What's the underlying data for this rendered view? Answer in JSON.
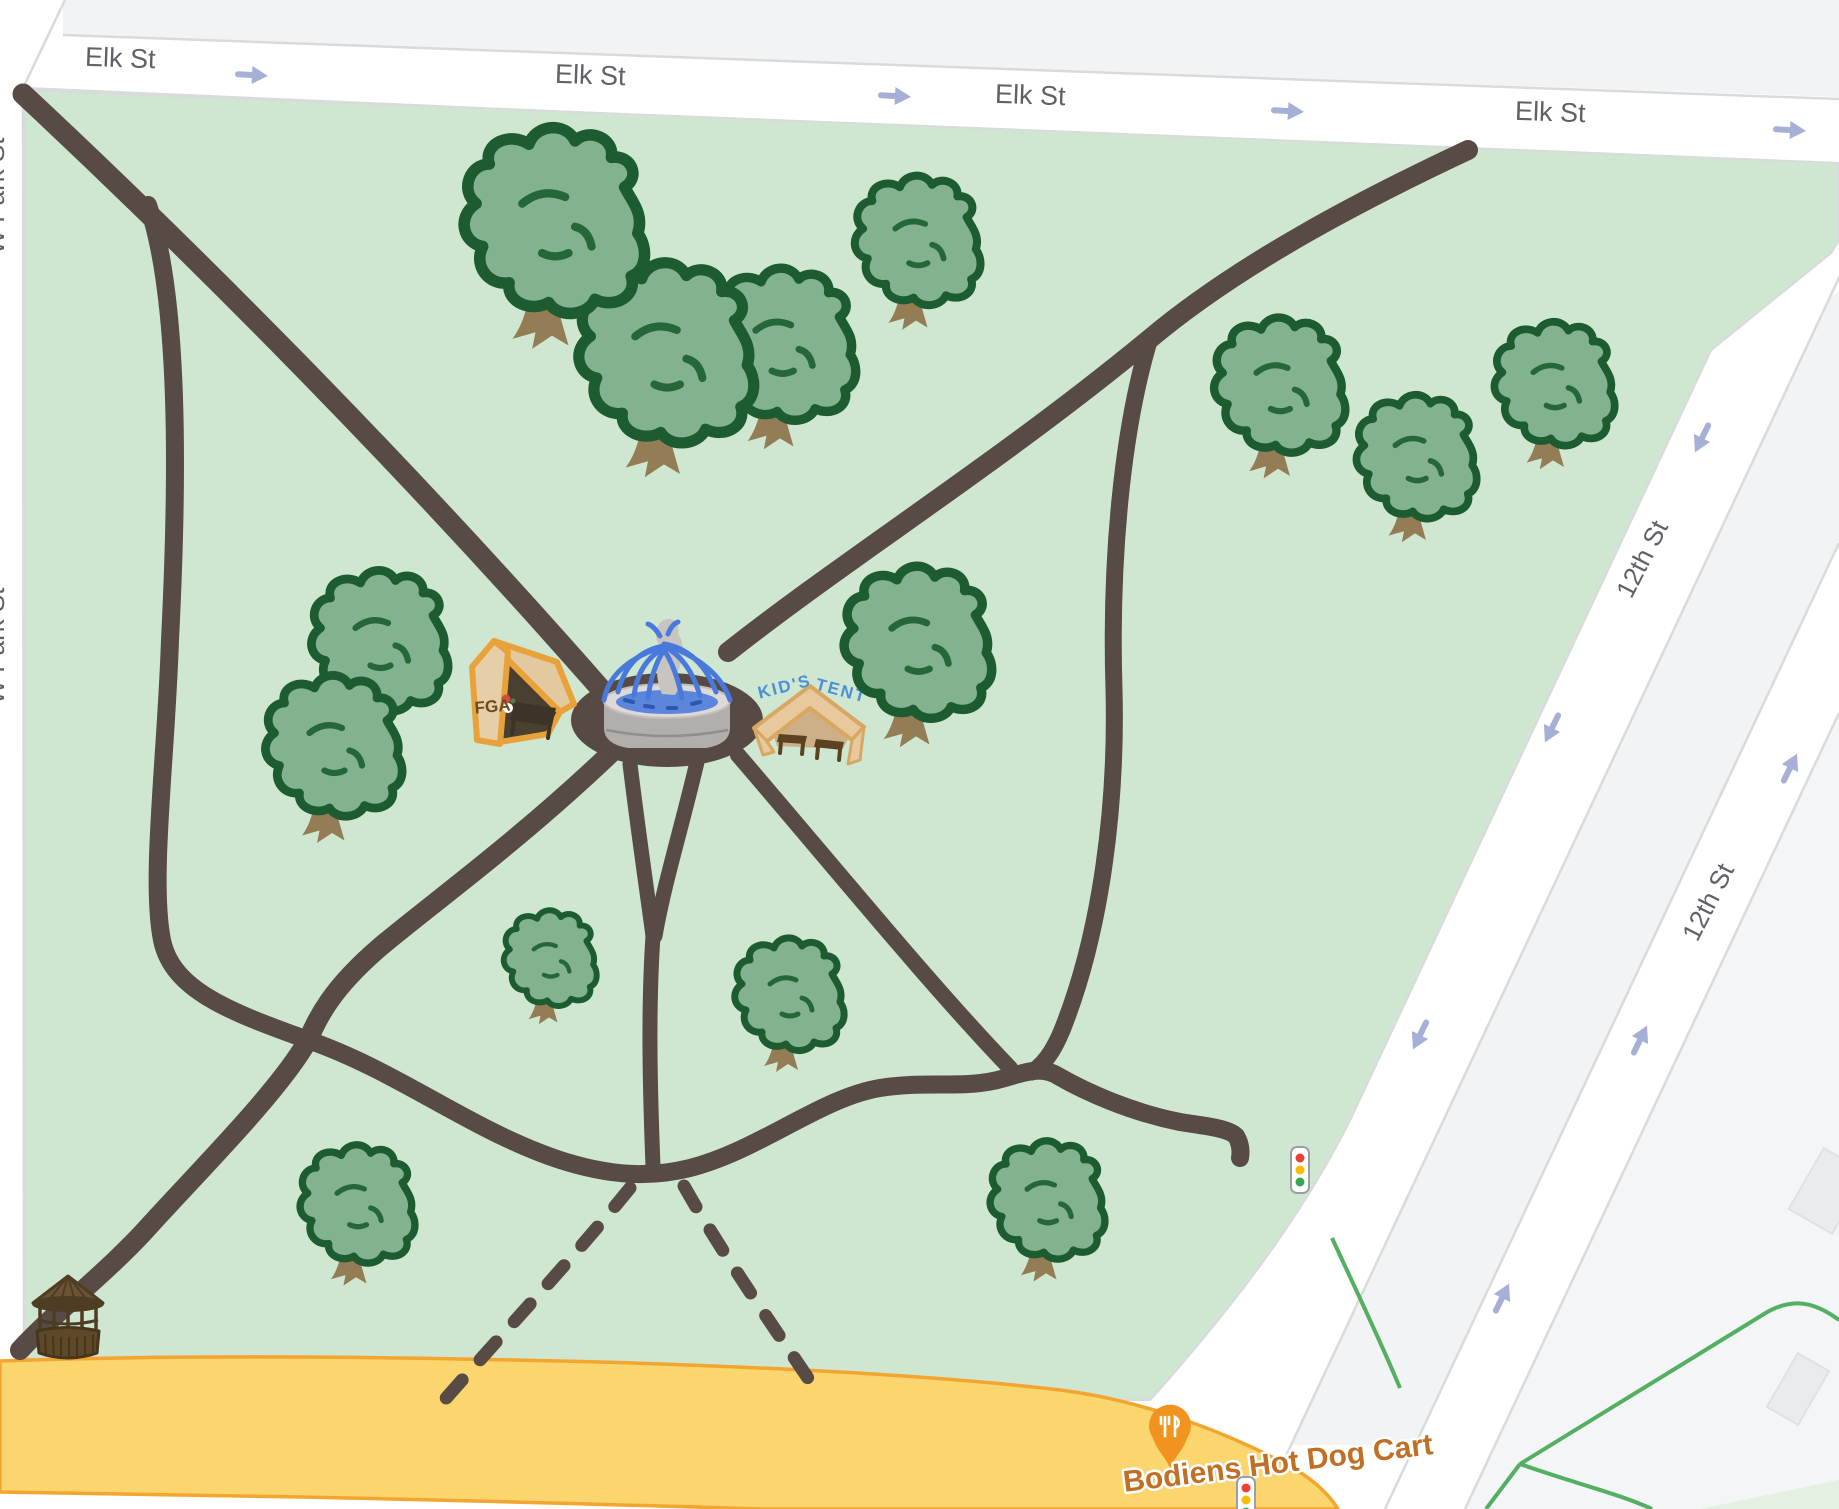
{
  "app": {
    "type": "map-view",
    "description": "park map with hand-drawn event overlay"
  },
  "streets": {
    "elk": {
      "name": "Elk St",
      "labels": [
        {
          "x": 120,
          "y": 67,
          "r": 2
        },
        {
          "x": 590,
          "y": 84,
          "r": 2
        },
        {
          "x": 1030,
          "y": 104,
          "r": 2
        },
        {
          "x": 1550,
          "y": 121,
          "r": 2
        }
      ],
      "arrows": [
        {
          "x": 252,
          "y": 75,
          "r": 3
        },
        {
          "x": 895,
          "y": 96,
          "r": 3
        },
        {
          "x": 1288,
          "y": 111,
          "r": 3
        },
        {
          "x": 1790,
          "y": 130,
          "r": 3
        }
      ]
    },
    "twelfth": {
      "name": "12th St",
      "labels": [
        {
          "x": 1650,
          "y": 563,
          "r": -63
        },
        {
          "x": 1716,
          "y": 906,
          "r": -63
        }
      ],
      "arrows_southbound": [
        {
          "x": 1702,
          "y": 438,
          "r": 116
        },
        {
          "x": 1552,
          "y": 728,
          "r": 116
        },
        {
          "x": 1420,
          "y": 1035,
          "r": 116
        }
      ],
      "arrows_northbound": [
        {
          "x": 1790,
          "y": 768,
          "r": -64
        },
        {
          "x": 1640,
          "y": 1040,
          "r": -64
        },
        {
          "x": 1502,
          "y": 1298,
          "r": -64
        }
      ]
    },
    "wpark": {
      "name": "W Park St",
      "labels": [
        {
          "x": 4,
          "y": 196,
          "r": -90
        },
        {
          "x": 4,
          "y": 646,
          "r": -90
        }
      ]
    }
  },
  "poi": {
    "food_cart": {
      "label": "Bodiens Hot Dog Cart",
      "x": 1278,
      "y": 1463,
      "r": -7,
      "pin": {
        "x": 1170,
        "y": 1427,
        "icon": "fork-knife-pin"
      }
    }
  },
  "park": {
    "fountain": {
      "x": 667,
      "y": 700,
      "icon": "fountain"
    },
    "fga_tent": {
      "label": "FGA",
      "x": 515,
      "y": 695,
      "icon": "orange-canopy-tent"
    },
    "kids_tent": {
      "label_line1": "KID'S",
      "label_line2": "TENT",
      "x": 808,
      "y": 720,
      "icon": "tan-canopy-tent"
    },
    "gazebo": {
      "x": 68,
      "y": 1315,
      "icon": "gazebo"
    },
    "trees": [
      {
        "x": 780,
        "y": 352,
        "s": 1.35
      },
      {
        "x": 664,
        "y": 362,
        "s": 1.6
      },
      {
        "x": 552,
        "y": 230,
        "s": 1.65
      },
      {
        "x": 916,
        "y": 247,
        "s": 1.15
      },
      {
        "x": 1278,
        "y": 392,
        "s": 1.2
      },
      {
        "x": 1415,
        "y": 463,
        "s": 1.1
      },
      {
        "x": 1553,
        "y": 390,
        "s": 1.1
      },
      {
        "x": 378,
        "y": 648,
        "s": 1.25
      },
      {
        "x": 332,
        "y": 753,
        "s": 1.25
      },
      {
        "x": 916,
        "y": 650,
        "s": 1.35
      },
      {
        "x": 549,
        "y": 963,
        "s": 0.85
      },
      {
        "x": 788,
        "y": 1000,
        "s": 1.0
      },
      {
        "x": 356,
        "y": 1210,
        "s": 1.05
      },
      {
        "x": 1046,
        "y": 1206,
        "s": 1.05
      }
    ],
    "traffic_lights": [
      {
        "x": 1300,
        "y": 1170
      },
      {
        "x": 1246,
        "y": 1500
      }
    ]
  },
  "colors": {
    "park_green": "#cfe7d1",
    "path_brown": "#584a44",
    "street_label": "#5e6266",
    "arrow_blue": "#a6afd6",
    "yellow_road": "#fbd66f",
    "yellow_border": "#f2a52f",
    "poi_orange": "#c06f25",
    "pin_orange": "#f0941f",
    "tent_orange": "#e8a23b",
    "tent_tan": "#e7c99d",
    "kids_text_blue": "#4b8fd9",
    "tree_fill": "#82b290",
    "tree_outline": "#1d5c30",
    "water_blue": "#4a79dc",
    "block_gray": "#f1f3f4",
    "crosspark_line_green": "#55af63"
  }
}
